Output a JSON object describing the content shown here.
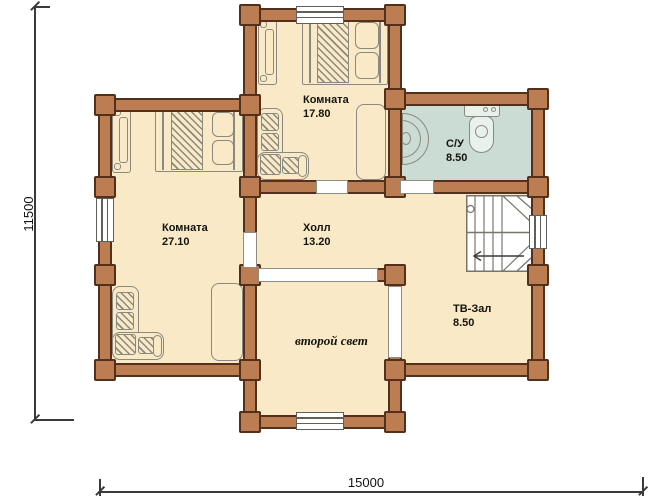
{
  "rooms": [
    {
      "name": "Комната",
      "area": "17.80"
    },
    {
      "name": "Комната",
      "area": "27.10"
    },
    {
      "name": "Холл",
      "area": "13.20"
    },
    {
      "name": "С/У",
      "area": "8.50"
    },
    {
      "name": "ТВ-Зал",
      "area": "8.50"
    },
    {
      "name": "второй свет",
      "area": ""
    }
  ],
  "dimensions": {
    "vertical": "11500",
    "horizontal": "15000"
  },
  "colors": {
    "wall_fill": "#bc7d52",
    "wall_outline": "#53301c",
    "floor": "#f9e9c6",
    "bathroom_floor": "#cadcd3",
    "furniture_line": "#8a897f",
    "dimension_line": "#3a3a3a"
  }
}
